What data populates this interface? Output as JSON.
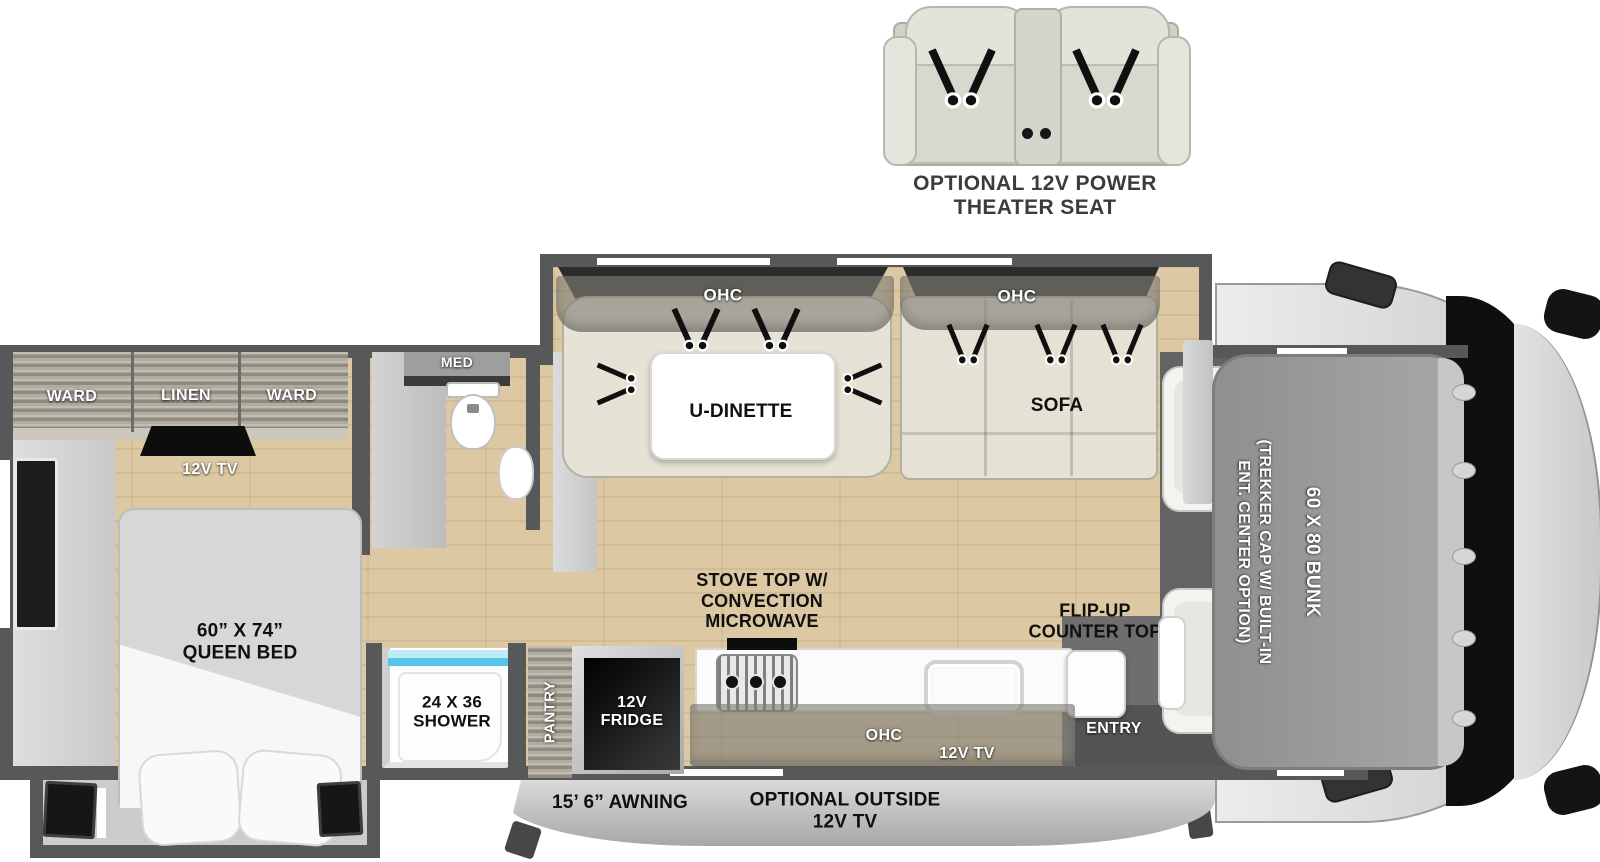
{
  "theater": {
    "label": "OPTIONAL 12V POWER\nTHEATER SEAT"
  },
  "bedroom": {
    "ward_left": "WARD",
    "linen": "LINEN",
    "ward_right": "WARD",
    "tv": "12V TV",
    "queen_bed": "60” X 74”\nQUEEN BED"
  },
  "bathroom": {
    "med": "MED",
    "shower": "24 X 36\nSHOWER"
  },
  "living": {
    "dinette_ohc": "OHC",
    "dinette": "U-DINETTE",
    "sofa_ohc": "OHC",
    "sofa": "SOFA"
  },
  "kitchen": {
    "stove": "STOVE TOP W/\nCONVECTION\nMICROWAVE",
    "flip_counter": "FLIP-UP\nCOUNTER TOP",
    "pantry": "PANTRY",
    "fridge": "12V\nFRIDGE",
    "ohc": "OHC",
    "tv": "12V TV"
  },
  "entry": {
    "label": "ENTRY"
  },
  "bunk": {
    "size": "60 X 80 BUNK",
    "option": "(TREKKER CAP W/ BUILT-IN\nENT. CENTER OPTION)"
  },
  "exterior": {
    "awning": "15’ 6” AWNING",
    "outside_tv": "OPTIONAL OUTSIDE\n12V TV"
  },
  "colors": {
    "wall": "#57585a",
    "floor": "#dcc9a4",
    "shower_glass": "#54c6e8"
  }
}
